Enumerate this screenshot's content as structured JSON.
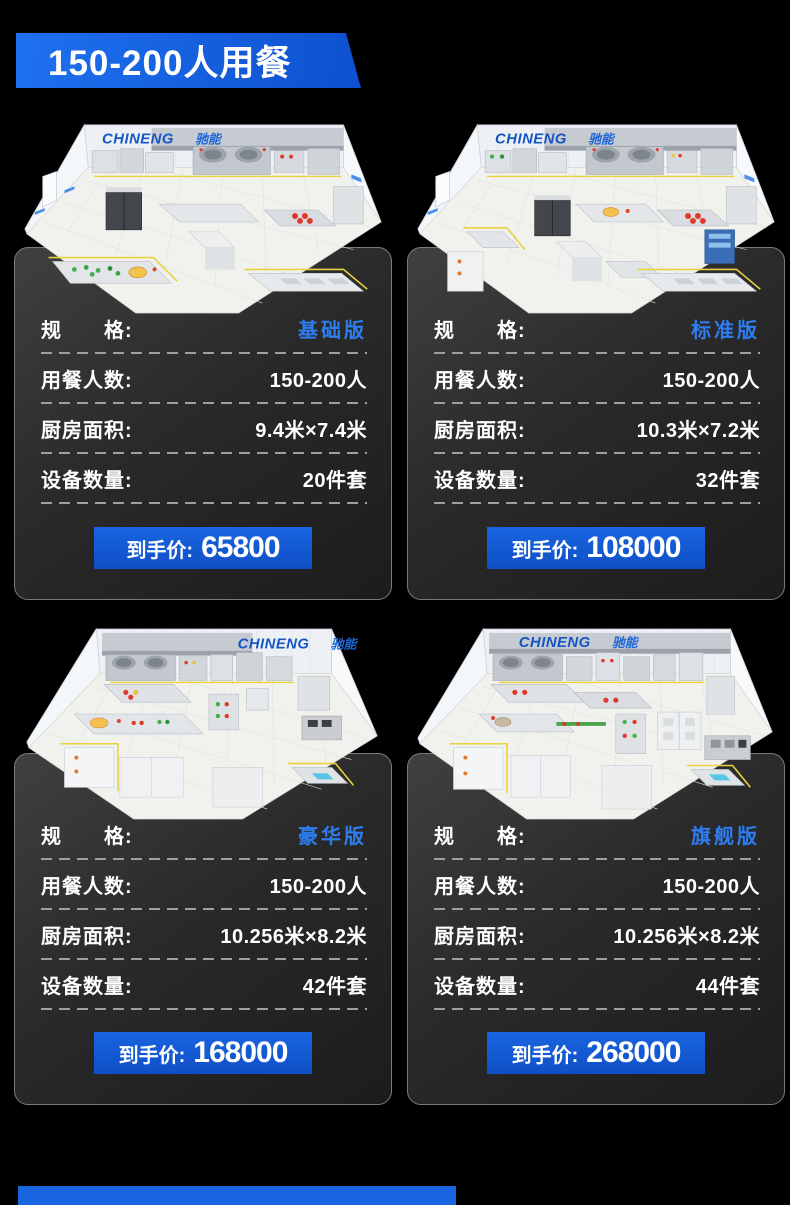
{
  "colors": {
    "page_bg": "#000000",
    "banner_blue": "#1565e6",
    "price_button_blue": "#1257d8",
    "variant_text_blue": "#2e7df0",
    "brand_logo_blue": "#1556c4",
    "floor_safety_yellow": "#e8d23f",
    "bottom_strip_blue": "#1a66e0"
  },
  "banner": {
    "title": "150-200人用餐"
  },
  "brand": {
    "en": "CHINENG",
    "cn": "驰能"
  },
  "labels": {
    "spec": "规　　格:",
    "diners": "用餐人数:",
    "area": "厨房面积:",
    "equipment": "设备数量:",
    "price": "到手价:"
  },
  "cards": [
    {
      "variant": "基础版",
      "diners": "150-200人",
      "area": "9.4米×7.4米",
      "equipment": "20件套",
      "price": "65800",
      "kitchen": {
        "logo_x_en": "88",
        "logo_x_cn": "182"
      }
    },
    {
      "variant": "标准版",
      "diners": "150-200人",
      "area": "10.3米×7.2米",
      "equipment": "32件套",
      "price": "108000",
      "kitchen": {
        "logo_x_en": "88",
        "logo_x_cn": "182"
      }
    },
    {
      "variant": "豪华版",
      "diners": "150-200人",
      "area": "10.256米×8.2米",
      "equipment": "42件套",
      "price": "168000",
      "kitchen": {
        "logo_x_en": "225",
        "logo_x_cn": "319"
      }
    },
    {
      "variant": "旗舰版",
      "diners": "150-200人",
      "area": "10.256米×8.2米",
      "equipment": "44件套",
      "price": "268000",
      "kitchen": {
        "logo_x_en": "112",
        "logo_x_cn": "206"
      }
    }
  ]
}
